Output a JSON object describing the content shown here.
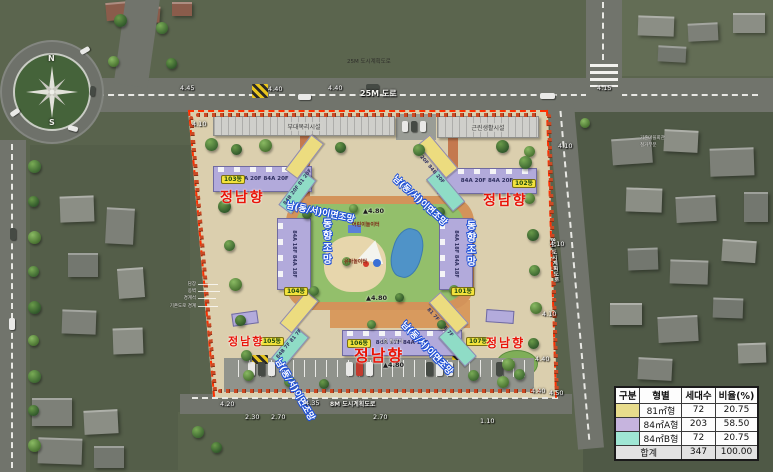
{
  "compass": {
    "north": "N",
    "south": "S"
  },
  "roads": {
    "top_name": "25M 도로",
    "top_planning": "25M 도시계획도로",
    "bottom_name": "8M 도시계획도로",
    "right_name": "8M 도시계획도로"
  },
  "site": {
    "facility_left": "부대복리시설",
    "facility_right": "근린생활시설",
    "south_facing": "정남향",
    "diagonal_view": "남(동/서)이면조망",
    "east_view": "동향조망",
    "elevation": "▲4.80",
    "piloti": "1층 필로티",
    "playground_child": "어린이놀이터",
    "playground_infant": "유아놀이터",
    "buildings": {
      "b101": {
        "badge": "101동",
        "spec": "84A 18F  84A 18F"
      },
      "b102": {
        "badge": "102동",
        "spec": "84A 20F  84A 20F"
      },
      "b103": {
        "badge": "103동",
        "spec": "84A 20F  84A 20F"
      },
      "b104": {
        "badge": "104동",
        "spec": "84A 18F  84A 18F"
      },
      "b105": {
        "badge": "105동",
        "spec": "84B 7F  81 7F"
      },
      "b106": {
        "badge": "106동",
        "spec": "84A 17F  84A 17F"
      },
      "b107": {
        "badge": "107동",
        "spec": "81 7F  84B 7F"
      },
      "wing_tl": {
        "spec": "84B 20F  81 20F"
      },
      "wing_tr": {
        "spec": "81 20F  84B 20F"
      }
    }
  },
  "dims": [
    "4.45",
    "4.40",
    "4.40",
    "4.10",
    "4.15",
    "4.10",
    "4.10",
    "4.10",
    "4.40",
    "4.40",
    "4.50",
    "4.20",
    "4.35",
    "2.30",
    "2.70",
    "2.70",
    "1.10"
  ],
  "annotations": {
    "left": [
      "담장",
      "옹벽",
      "경계석",
      "기존도로 경계"
    ],
    "right": [
      "기존마을회관",
      "철거부분"
    ]
  },
  "legend": {
    "headers": [
      "구분",
      "형별",
      "세대수",
      "비율(%)"
    ],
    "rows": [
      {
        "color": "#e8dc8c",
        "type": "81㎡형",
        "count": "72",
        "ratio": "20.75"
      },
      {
        "color": "#c6b4de",
        "type": "84㎡A형",
        "count": "203",
        "ratio": "58.50"
      },
      {
        "color": "#9fe6d4",
        "type": "84㎡B형",
        "count": "72",
        "ratio": "20.75"
      }
    ],
    "total_label": "합계",
    "total_count": "347",
    "total_ratio": "100.00"
  }
}
